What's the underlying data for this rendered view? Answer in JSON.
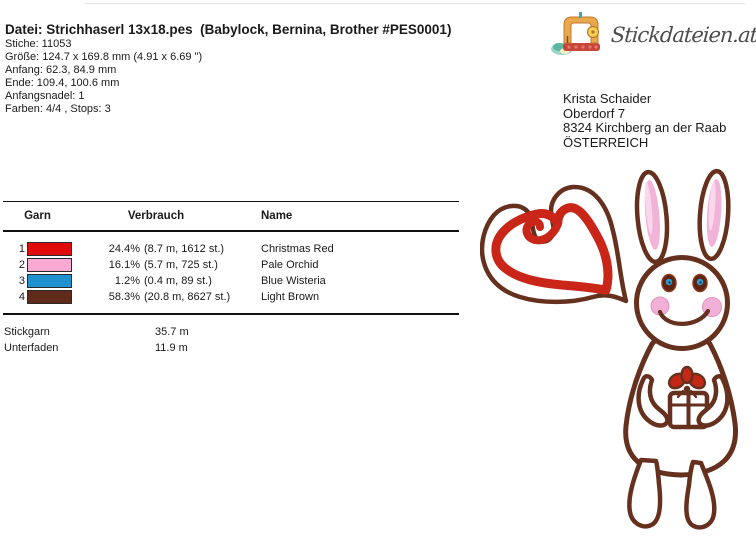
{
  "header": {
    "title": "Datei: Strichhaserl 13x18.pes  (Babylock, Bernina, Brother #PES0001)",
    "lines": [
      "Stiche: 11053",
      "Größe: 124.7 x 169.8 mm (4.91 x 6.69 \")",
      "Anfang: 62.3, 84.9 mm",
      "Ende: 109.4, 100.6 mm",
      "Anfangsnadel: 1",
      "Farben: 4/4 , Stops: 3"
    ]
  },
  "logo": {
    "text": "Stickdateien.at",
    "icon": "sewing-machine-icon"
  },
  "address": {
    "lines": [
      "Krista Schaider",
      "Oberdorf 7",
      "8324 Kirchberg an der Raab",
      "ÖSTERREICH"
    ]
  },
  "thread_table": {
    "columns": [
      "Garn",
      "Verbrauch",
      "Name"
    ],
    "rows": [
      {
        "num": "1",
        "color": "#e00a0c",
        "pct": "24.4%",
        "detail": "(8.7 m, 1612 st.)",
        "name": "Christmas Red"
      },
      {
        "num": "2",
        "color": "#f9a9d2",
        "pct": "16.1%",
        "detail": "(5.7 m, 725 st.)",
        "name": "Pale Orchid"
      },
      {
        "num": "3",
        "color": "#2191cf",
        "pct": "1.2%",
        "detail": "(0.4 m, 89 st.)",
        "name": "Blue Wisteria"
      },
      {
        "num": "4",
        "color": "#5f2a1a",
        "pct": "58.3%",
        "detail": "(20.8 m, 8627 st.)",
        "name": "Light Brown"
      }
    ],
    "totals": [
      {
        "label": "Stickgarn",
        "value": "35.7 m"
      },
      {
        "label": "Unterfaden",
        "value": "11.9 m"
      }
    ]
  },
  "design": {
    "label": "bunny-with-heart-and-gift-embroidery-preview",
    "colors": {
      "outline_brown": "#66301f",
      "heart_red": "#c92518",
      "ear_pink": "#f2b3d8",
      "cheek_pink": "#f2b0d6",
      "eye_blue": "#2d9fd6",
      "bow_red": "#c22717"
    }
  }
}
